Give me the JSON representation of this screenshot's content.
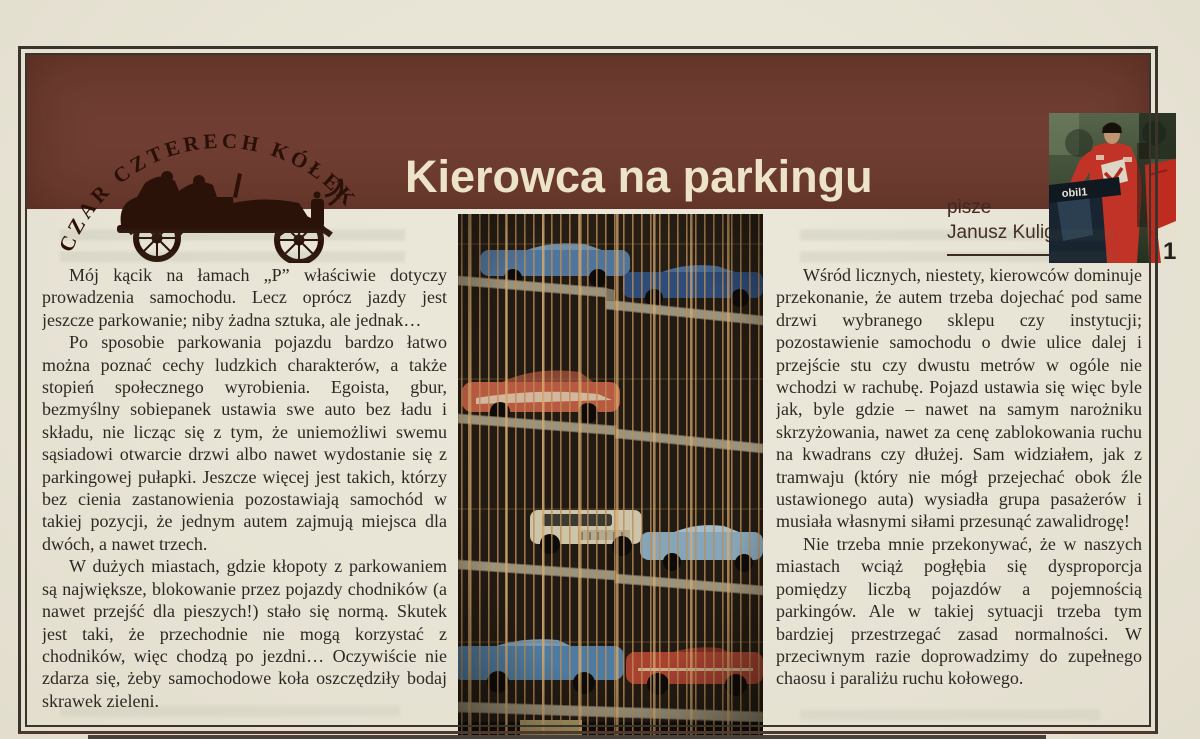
{
  "page": {
    "paper_color": "#e8e4d5",
    "frame_color": "#3b342c",
    "language": "pl"
  },
  "header": {
    "panel_color": "#6f3d31",
    "rubric": "CZAR CZTERECH KÓŁEK",
    "title": "Kierowca na parkingu",
    "title_color": "#ece3c8",
    "byline_label": "pisze",
    "byline_name": "Janusz Kulig",
    "photo": {
      "subject": "rally-driver-in-red-race-suit-beside-red-car",
      "sponsor_text": "obil1",
      "door_number": "1"
    }
  },
  "article": {
    "left_column": [
      "Mój kącik na łamach „P” właściwie dotyczy prowadzenia samochodu. Lecz oprócz jazdy jest jeszcze parkowanie; niby żadna sztuka, ale jednak…",
      "Po sposobie parkowania pojazdu bardzo łatwo można poznać cechy ludzkich charakterów, a także stopień społecznego wyrobienia. Egoista, gbur, bezmyślny sobiepanek ustawia swe auto bez ładu i składu, nie licząc się z tym, że uniemożliwi swemu sąsiadowi otwarcie drzwi albo nawet wydostanie się z parkingowej pułapki. Jeszcze więcej jest takich, którzy bez cienia zastanowienia pozostawiają samochód w takiej pozycji, że jednym autem zajmują miejsca dla dwóch, a nawet trzech.",
      "W dużych miastach, gdzie kłopoty z parkowaniem są największe, blokowanie przez pojazdy chodników (a nawet przejść dla pieszych!) stało się normą. Skutek jest taki, że przechodnie nie mogą korzystać z chodników, więc chodzą po jezdni… Oczywiście nie zdarza się, żeby samochodowe koła oszczędziły bodaj skrawek zieleni."
    ],
    "right_column": [
      "Wśród licznych, niestety, kierowców dominuje przekonanie, że autem trzeba dojechać pod same drzwi wybranego sklepu czy instytucji; pozostawienie samochodu o dwie ulice dalej i przejście stu czy dwustu metrów w ogóle nie wchodzi w rachubę. Pojazd ustawia się więc byle jak, byle gdzie – nawet na samym narożniku skrzyżowania, nawet za cenę zablokowania ruchu na kwadrans czy dłużej. Sam widziałem, jak z tramwaju (który nie mógł przejechać obok źle ustawionego auta) wysiadła grupa pasażerów i musiała własnymi siłami przesunąć zawalidrogę!",
      "Nie trzeba mnie przekonywać, że w naszych miastach wciąż pogłębia się dysproporcja pomiędzy liczbą pojazdów a pojemnością parkingów. Ale w takiej sytuacji trzeba tym bardziej przestrzegać zasad normalności. W przeciwnym razie doprowadzimy do zupełnego chaosu i paraliżu ruchu kołowego."
    ]
  },
  "center_photo": {
    "subject": "multi-storey-parking-garage-with-vintage-cars-behind-cage-bars"
  }
}
